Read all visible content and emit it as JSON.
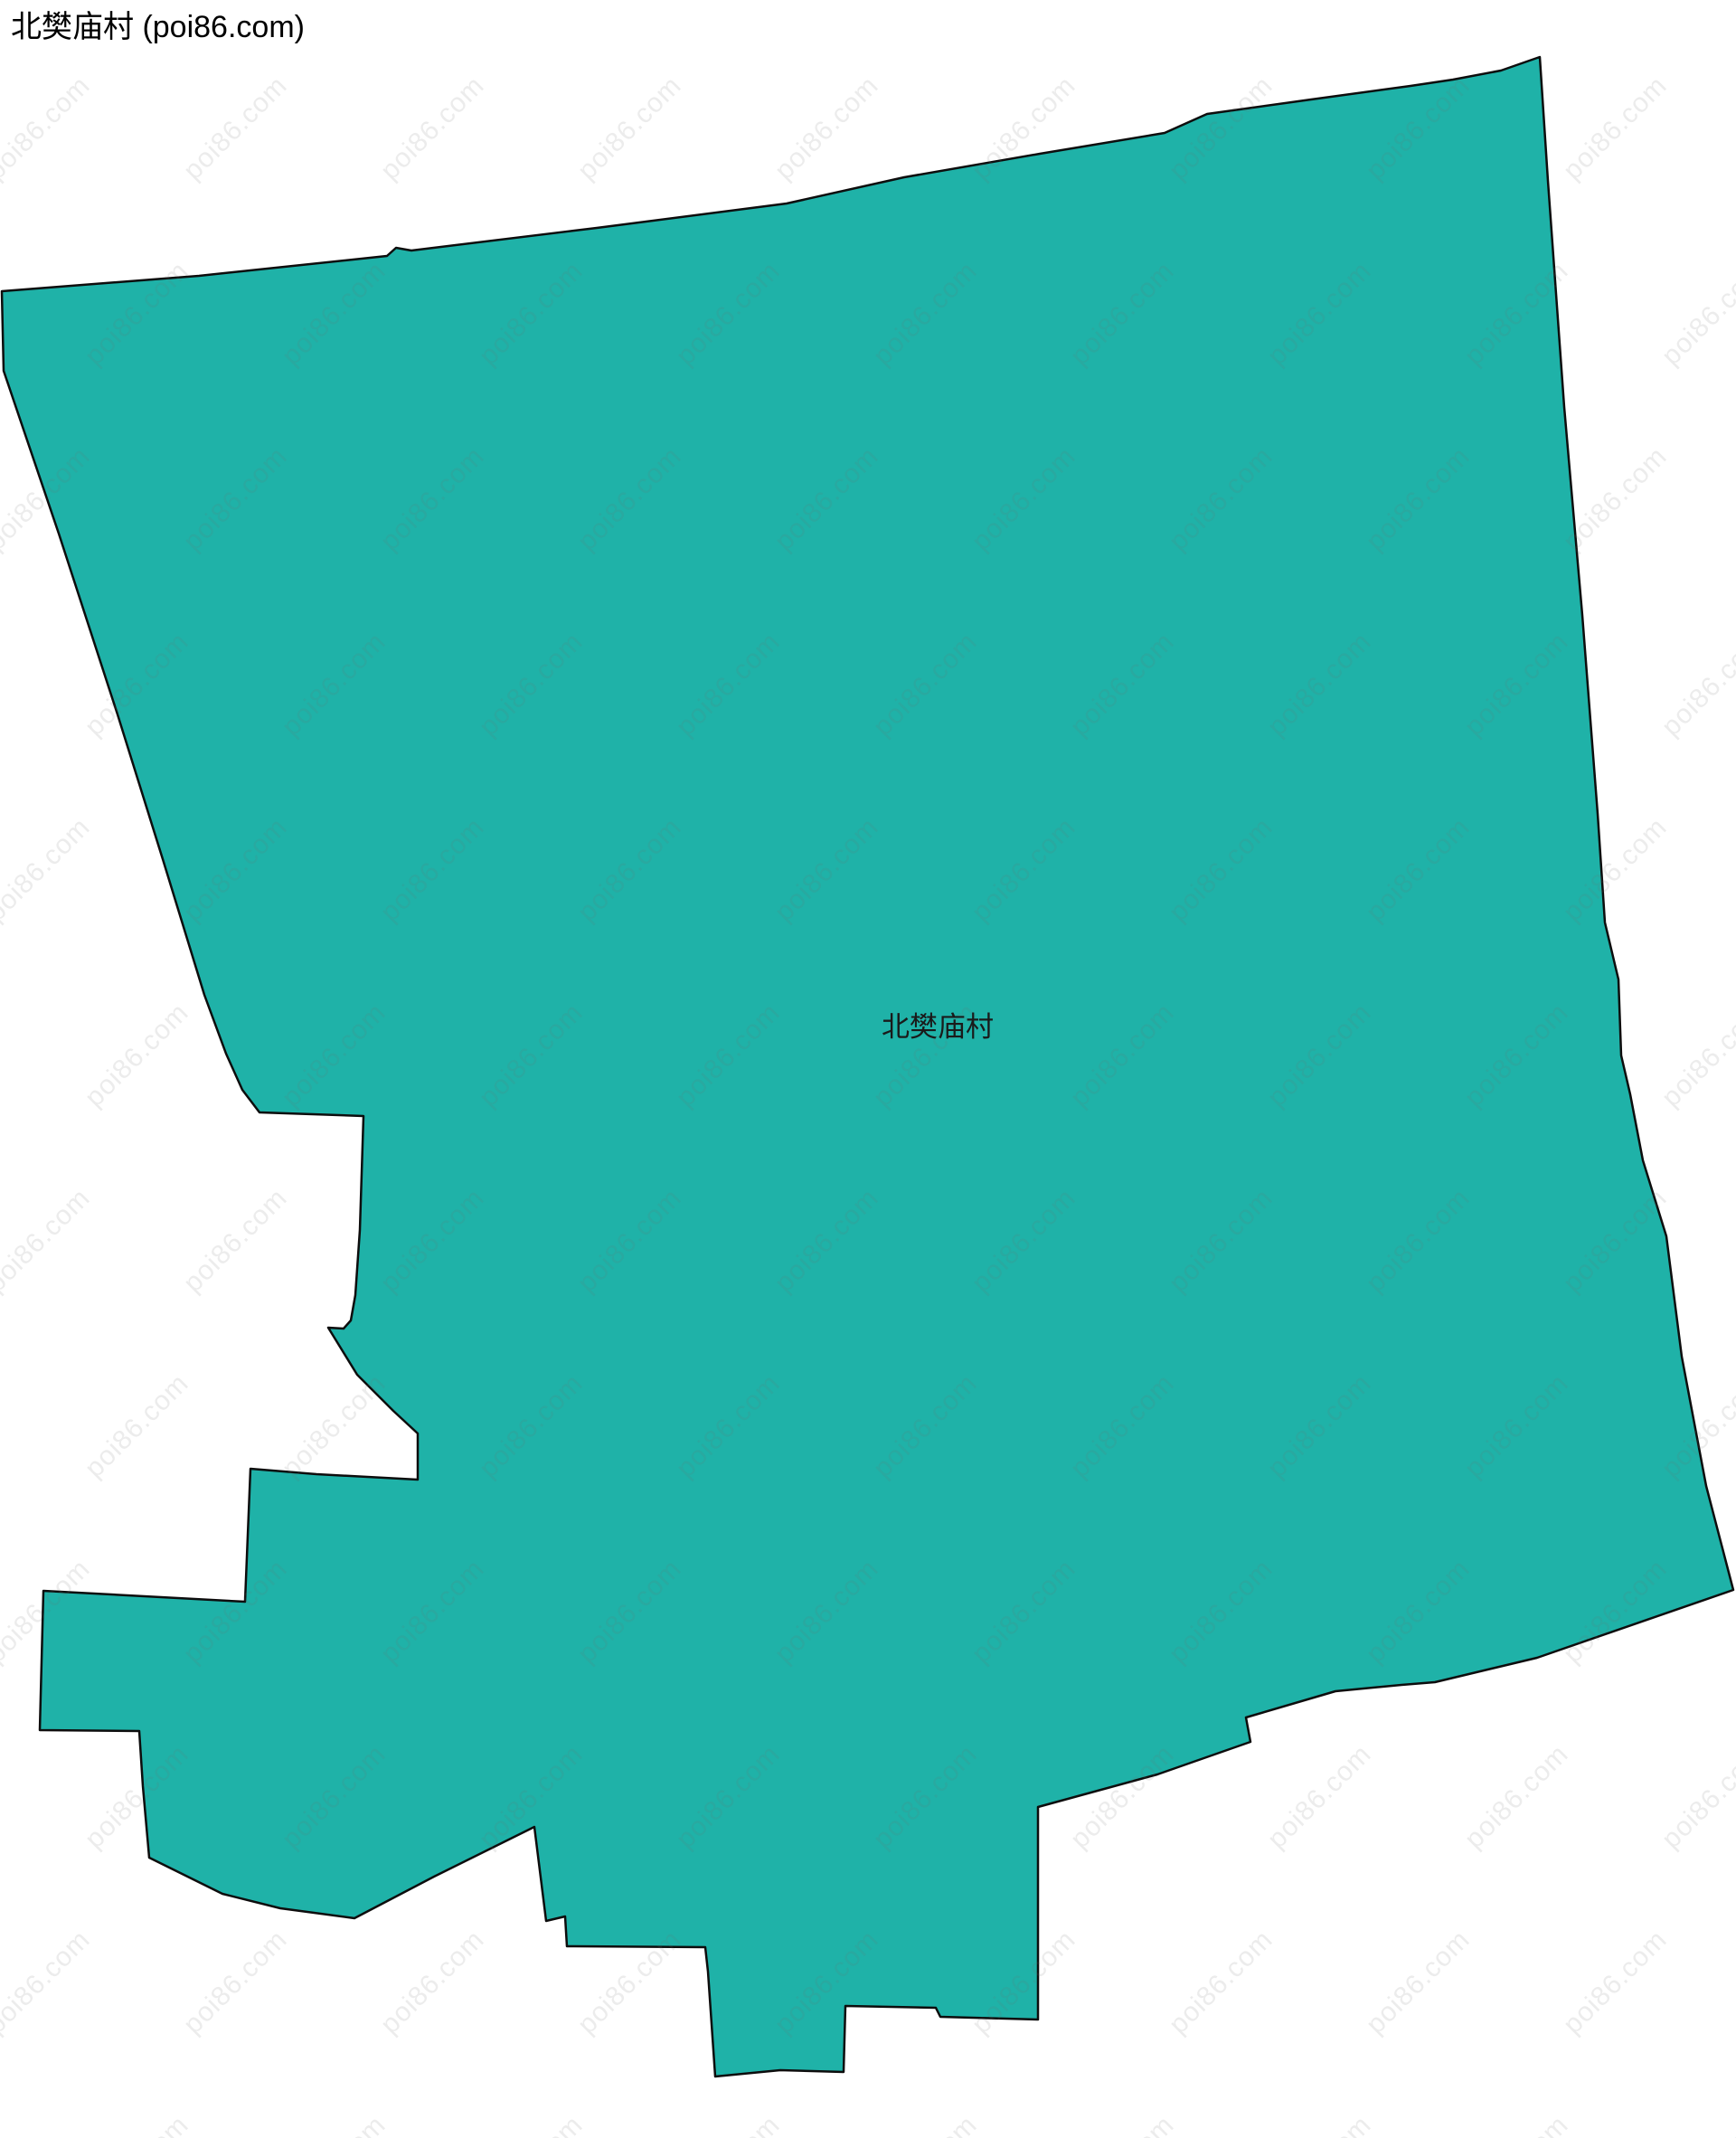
{
  "page": {
    "title": "北樊庙村 (poi86.com)"
  },
  "map": {
    "region_label": "北樊庙村",
    "watermark_text": "poi86.com",
    "colors": {
      "region_fill": "#1FB2A8",
      "region_stroke": "#0d0d0d",
      "background": "#FFFFFF",
      "watermark": "rgba(110,110,110,0.13)",
      "title_color": "#000000",
      "label_color": "#1A1A1A"
    },
    "boundary_points": [
      [
        2,
        322
      ],
      [
        220,
        305
      ],
      [
        428,
        283
      ],
      [
        438,
        274
      ],
      [
        455,
        277
      ],
      [
        660,
        252
      ],
      [
        870,
        225
      ],
      [
        1000,
        196
      ],
      [
        1150,
        170
      ],
      [
        1288,
        147
      ],
      [
        1335,
        126
      ],
      [
        1450,
        110
      ],
      [
        1560,
        95
      ],
      [
        1607,
        88
      ],
      [
        1660,
        78
      ],
      [
        1703,
        63
      ],
      [
        1712,
        200
      ],
      [
        1730,
        450
      ],
      [
        1750,
        680
      ],
      [
        1767,
        900
      ],
      [
        1775,
        1020
      ],
      [
        1790,
        1083
      ],
      [
        1793,
        1167
      ],
      [
        1803,
        1210
      ],
      [
        1817,
        1283
      ],
      [
        1843,
        1367
      ],
      [
        1860,
        1500
      ],
      [
        1887,
        1643
      ],
      [
        1917,
        1758
      ],
      [
        1700,
        1833
      ],
      [
        1587,
        1860
      ],
      [
        1550,
        1863
      ],
      [
        1477,
        1870
      ],
      [
        1378,
        1899
      ],
      [
        1383,
        1926
      ],
      [
        1280,
        1962
      ],
      [
        1148,
        1998
      ],
      [
        1148,
        2233
      ],
      [
        1040,
        2230
      ],
      [
        1035,
        2220
      ],
      [
        935,
        2218
      ],
      [
        933,
        2291
      ],
      [
        863,
        2289
      ],
      [
        791,
        2296
      ],
      [
        783,
        2180
      ],
      [
        780,
        2153
      ],
      [
        627,
        2152
      ],
      [
        625,
        2119
      ],
      [
        604,
        2124
      ],
      [
        591,
        2020
      ],
      [
        480,
        2075
      ],
      [
        392,
        2121
      ],
      [
        310,
        2110
      ],
      [
        246,
        2094
      ],
      [
        165,
        2054
      ],
      [
        158,
        1975
      ],
      [
        154,
        1914
      ],
      [
        44,
        1913
      ],
      [
        48,
        1759
      ],
      [
        271,
        1771
      ],
      [
        277,
        1624
      ],
      [
        350,
        1630
      ],
      [
        462,
        1636
      ],
      [
        462,
        1585
      ],
      [
        435,
        1560
      ],
      [
        395,
        1520
      ],
      [
        363,
        1468
      ],
      [
        380,
        1469
      ],
      [
        388,
        1460
      ],
      [
        393,
        1432
      ],
      [
        398,
        1360
      ],
      [
        402,
        1234
      ],
      [
        287,
        1230
      ],
      [
        268,
        1205
      ],
      [
        250,
        1165
      ],
      [
        226,
        1100
      ],
      [
        180,
        950
      ],
      [
        130,
        790
      ],
      [
        65,
        590
      ],
      [
        4,
        410
      ]
    ]
  }
}
